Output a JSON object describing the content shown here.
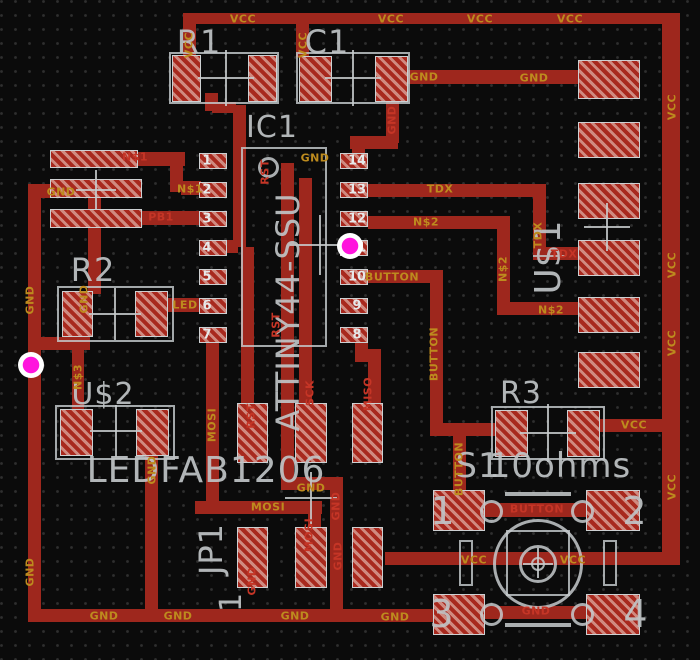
{
  "title": "PCB layout canvas - ATTINY44 board",
  "colors": {
    "background": "#0b0b0b",
    "grid_dot": "#2f2f2f",
    "copper_trace": "#9e271d",
    "pad_stripe_dark": "#a8291e",
    "pad_stripe_light": "#d08a80",
    "silkscreen": "#c0c4c6",
    "net_label_orange": "#bd8b1e",
    "net_label_red": "#c53526",
    "pin_number": "#e6e9ea",
    "click_marker": "#ff14dd"
  },
  "traces": [
    [
      183,
      13,
      479,
      11,
      "VCC"
    ],
    [
      662,
      13,
      18,
      552,
      "VCC"
    ],
    [
      183,
      24,
      13,
      34,
      "VCC"
    ],
    [
      296,
      24,
      13,
      33,
      "VCC"
    ],
    [
      407,
      70,
      172,
      14,
      "GND"
    ],
    [
      386,
      100,
      13,
      43,
      "GND"
    ],
    [
      350,
      136,
      48,
      13,
      "GND"
    ],
    [
      352,
      145,
      13,
      10,
      "GND"
    ],
    [
      205,
      93,
      13,
      18,
      "RST"
    ],
    [
      212,
      102,
      24,
      11,
      "RST"
    ],
    [
      233,
      105,
      13,
      142,
      "RST"
    ],
    [
      222,
      240,
      16,
      13,
      "RST"
    ],
    [
      241,
      247,
      13,
      158,
      "RST"
    ],
    [
      137,
      152,
      48,
      14,
      "N$1"
    ],
    [
      170,
      154,
      13,
      38,
      "N$1"
    ],
    [
      181,
      181,
      20,
      14,
      "N$1"
    ],
    [
      142,
      211,
      58,
      14,
      "PB1"
    ],
    [
      168,
      298,
      32,
      14,
      "LED"
    ],
    [
      28,
      184,
      26,
      14,
      "GND"
    ],
    [
      28,
      184,
      13,
      438,
      "GND"
    ],
    [
      88,
      196,
      13,
      98,
      "GND"
    ],
    [
      34,
      337,
      56,
      13,
      "GND"
    ],
    [
      72,
      335,
      12,
      77,
      "N$3"
    ],
    [
      145,
      453,
      13,
      160,
      "GND"
    ],
    [
      206,
      340,
      13,
      163,
      "MOSI"
    ],
    [
      195,
      501,
      127,
      13,
      "MOSI"
    ],
    [
      308,
      510,
      13,
      20,
      "MOSI"
    ],
    [
      281,
      163,
      13,
      316,
      "GND"
    ],
    [
      281,
      477,
      62,
      13,
      "GND"
    ],
    [
      330,
      477,
      13,
      136,
      "GND"
    ],
    [
      299,
      178,
      13,
      227,
      "SCK"
    ],
    [
      355,
      342,
      13,
      14,
      "MISO"
    ],
    [
      355,
      349,
      26,
      13,
      "MISO"
    ],
    [
      368,
      349,
      13,
      56,
      "MISO"
    ],
    [
      368,
      270,
      75,
      13,
      "BUTTON"
    ],
    [
      430,
      270,
      13,
      160,
      "BUTTON"
    ],
    [
      430,
      423,
      66,
      13,
      "BUTTON"
    ],
    [
      453,
      430,
      13,
      78,
      "BUTTON"
    ],
    [
      368,
      184,
      178,
      13,
      "TDX"
    ],
    [
      533,
      184,
      13,
      76,
      "TDX"
    ],
    [
      545,
      247,
      34,
      13,
      "TDX"
    ],
    [
      368,
      216,
      142,
      13,
      "N$2"
    ],
    [
      497,
      216,
      13,
      99,
      "N$2"
    ],
    [
      497,
      302,
      82,
      13,
      "N$2"
    ],
    [
      600,
      419,
      64,
      13,
      "VCC"
    ],
    [
      385,
      552,
      295,
      13,
      "VCC"
    ],
    [
      28,
      609,
      444,
      13,
      "GND"
    ],
    [
      485,
      503,
      102,
      14,
      "BUTTON"
    ],
    [
      485,
      606,
      102,
      13,
      "GND"
    ]
  ],
  "pads": [
    [
      172,
      55,
      29,
      47,
      "R1"
    ],
    [
      248,
      55,
      29,
      47,
      "R1"
    ],
    [
      299,
      56,
      33,
      46,
      "C1"
    ],
    [
      375,
      56,
      33,
      46,
      "C1"
    ],
    [
      50,
      150,
      88,
      18,
      "conn"
    ],
    [
      50,
      179,
      92,
      19,
      "conn"
    ],
    [
      50,
      209,
      92,
      19,
      "conn"
    ],
    [
      199,
      153,
      28,
      16,
      "IC1"
    ],
    [
      199,
      182,
      28,
      16,
      "IC1"
    ],
    [
      199,
      211,
      28,
      16,
      "IC1"
    ],
    [
      199,
      240,
      28,
      16,
      "IC1"
    ],
    [
      199,
      269,
      28,
      16,
      "IC1"
    ],
    [
      199,
      298,
      28,
      16,
      "IC1"
    ],
    [
      199,
      327,
      28,
      16,
      "IC1"
    ],
    [
      340,
      153,
      28,
      16,
      "IC1"
    ],
    [
      340,
      182,
      28,
      16,
      "IC1"
    ],
    [
      340,
      211,
      28,
      16,
      "IC1"
    ],
    [
      340,
      240,
      28,
      16,
      "IC1"
    ],
    [
      340,
      269,
      28,
      16,
      "IC1"
    ],
    [
      340,
      298,
      28,
      16,
      "IC1"
    ],
    [
      340,
      327,
      28,
      16,
      "IC1"
    ],
    [
      62,
      291,
      31,
      46,
      "R2"
    ],
    [
      135,
      291,
      33,
      46,
      "R2"
    ],
    [
      60,
      409,
      33,
      47,
      "U$2"
    ],
    [
      136,
      409,
      33,
      47,
      "U$2"
    ],
    [
      237,
      403,
      31,
      60,
      "JP1"
    ],
    [
      295,
      403,
      32,
      60,
      "JP1"
    ],
    [
      352,
      403,
      31,
      60,
      "JP1"
    ],
    [
      237,
      527,
      31,
      61,
      "JP1"
    ],
    [
      295,
      527,
      32,
      61,
      "JP1"
    ],
    [
      352,
      527,
      31,
      61,
      "JP1"
    ],
    [
      495,
      410,
      33,
      47,
      "R3"
    ],
    [
      567,
      410,
      33,
      47,
      "R3"
    ],
    [
      433,
      490,
      52,
      41,
      "S1"
    ],
    [
      586,
      490,
      54,
      41,
      "S1"
    ],
    [
      433,
      594,
      52,
      41,
      "S1"
    ],
    [
      586,
      594,
      54,
      41,
      "S1"
    ],
    [
      578,
      60,
      62,
      39,
      "U$1"
    ],
    [
      578,
      122,
      62,
      36,
      "U$1"
    ],
    [
      578,
      183,
      62,
      36,
      "U$1"
    ],
    [
      578,
      240,
      62,
      36,
      "U$1"
    ],
    [
      578,
      297,
      62,
      36,
      "U$1"
    ],
    [
      578,
      352,
      62,
      36,
      "U$1"
    ]
  ],
  "outlines": [
    [
      169,
      52,
      110,
      52,
      2,
      "R1-body"
    ],
    [
      296,
      52,
      114,
      52,
      2,
      "C1-body"
    ],
    [
      241,
      147,
      86,
      200,
      2,
      "IC1-body"
    ],
    [
      57,
      286,
      117,
      56,
      2,
      "R2-body"
    ],
    [
      55,
      405,
      120,
      55,
      2,
      "U$2-body"
    ],
    [
      491,
      406,
      114,
      54,
      2,
      "R3-body"
    ],
    [
      506,
      530,
      64,
      66,
      2,
      "S1-plunger-square"
    ],
    [
      459,
      540,
      14,
      46,
      2,
      "S1-left-stem"
    ],
    [
      603,
      540,
      14,
      46,
      2,
      "S1-right-stem"
    ]
  ],
  "circles": [
    [
      258,
      157,
      21,
      3,
      "IC1-pin1-dot"
    ],
    [
      493,
      519,
      90,
      3,
      "S1-button-outer"
    ],
    [
      519,
      545,
      38,
      3,
      "S1-button-mid"
    ],
    [
      531,
      557,
      14,
      2,
      "S1-button-center"
    ],
    [
      480,
      500,
      23,
      3,
      "S1-ring-1"
    ],
    [
      571,
      500,
      23,
      3,
      "S1-ring-2"
    ],
    [
      480,
      603,
      23,
      3,
      "S1-ring-3"
    ],
    [
      571,
      603,
      23,
      3,
      "S1-ring-4"
    ]
  ],
  "lines": [
    [
      198,
      77,
      56,
      2
    ],
    [
      225,
      50,
      2,
      56
    ],
    [
      325,
      77,
      56,
      2
    ],
    [
      352,
      50,
      2,
      56
    ],
    [
      76,
      189,
      40,
      2
    ],
    [
      95,
      170,
      2,
      40
    ],
    [
      290,
      244,
      60,
      2
    ],
    [
      319,
      215,
      2,
      60
    ],
    [
      89,
      313,
      52,
      2
    ],
    [
      114,
      288,
      2,
      52
    ],
    [
      90,
      430,
      52,
      2
    ],
    [
      115,
      405,
      2,
      52
    ],
    [
      285,
      497,
      52,
      2
    ],
    [
      310,
      472,
      2,
      52
    ],
    [
      520,
      432,
      56,
      2
    ],
    [
      547,
      404,
      2,
      58
    ],
    [
      584,
      226,
      46,
      2
    ],
    [
      606,
      203,
      2,
      48
    ],
    [
      523,
      563,
      30,
      2
    ],
    [
      537,
      548,
      2,
      30
    ],
    [
      505,
      492,
      66,
      4
    ],
    [
      505,
      623,
      66,
      4
    ]
  ],
  "silk_texts": [
    [
      "R1",
      199,
      42,
      32,
      0
    ],
    [
      "C1",
      327,
      42,
      32,
      0
    ],
    [
      "IC1",
      272,
      128,
      30,
      0
    ],
    [
      "ATTINY44-SSU",
      288,
      312,
      32,
      1
    ],
    [
      "R2",
      93,
      270,
      32,
      0
    ],
    [
      "U$2",
      103,
      395,
      30,
      0
    ],
    [
      "LEDFAB1206",
      206,
      471,
      36,
      0
    ],
    [
      "JP1",
      211,
      549,
      32,
      1
    ],
    [
      "1",
      232,
      602,
      30,
      1
    ],
    [
      "R3",
      521,
      394,
      30,
      0
    ],
    [
      "S1",
      478,
      466,
      34,
      0
    ],
    [
      "10ohms",
      560,
      466,
      34,
      0
    ],
    [
      "U$1",
      549,
      257,
      36,
      1
    ],
    [
      "1",
      443,
      511,
      38,
      0
    ],
    [
      "2",
      635,
      511,
      38,
      0
    ],
    [
      "3",
      442,
      614,
      38,
      0
    ],
    [
      "4",
      636,
      614,
      38,
      0
    ]
  ],
  "pin_numbers": [
    [
      "1",
      207,
      161
    ],
    [
      "2",
      207,
      190
    ],
    [
      "3",
      207,
      219
    ],
    [
      "4",
      207,
      248
    ],
    [
      "5",
      207,
      277
    ],
    [
      "6",
      207,
      306
    ],
    [
      "7",
      207,
      335
    ],
    [
      "14",
      357,
      161
    ],
    [
      "13",
      357,
      190
    ],
    [
      "12",
      357,
      219
    ],
    [
      "11",
      357,
      248
    ],
    [
      "10",
      357,
      277
    ],
    [
      "9",
      357,
      306
    ],
    [
      "8",
      357,
      335
    ]
  ],
  "net_labels": [
    [
      "VCC",
      243,
      19,
      "orange",
      0
    ],
    [
      "VCC",
      391,
      19,
      "orange",
      0
    ],
    [
      "VCC",
      480,
      19,
      "orange",
      0
    ],
    [
      "VCC",
      570,
      19,
      "orange",
      0
    ],
    [
      "VCC",
      672,
      107,
      "orange",
      1
    ],
    [
      "VCC",
      672,
      265,
      "orange",
      1
    ],
    [
      "VCC",
      672,
      343,
      "orange",
      1
    ],
    [
      "VCC",
      672,
      487,
      "orange",
      1
    ],
    [
      "VCC",
      189,
      45,
      "orange",
      1
    ],
    [
      "VCC",
      303,
      45,
      "orange",
      1
    ],
    [
      "GND",
      424,
      77,
      "orange",
      0
    ],
    [
      "GND",
      534,
      78,
      "orange",
      0
    ],
    [
      "GND",
      392,
      120,
      "red",
      1
    ],
    [
      "GND",
      315,
      158,
      "orange",
      0
    ],
    [
      "RST",
      265,
      172,
      "red",
      1
    ],
    [
      "RST",
      276,
      325,
      "red",
      1
    ],
    [
      "RST",
      251,
      416,
      "red",
      1
    ],
    [
      "N$1",
      135,
      157,
      "red",
      0
    ],
    [
      "GND",
      61,
      192,
      "orange",
      0
    ],
    [
      "PB1",
      161,
      217,
      "red",
      0
    ],
    [
      "N$1",
      190,
      189,
      "orange",
      0
    ],
    [
      "GND",
      30,
      300,
      "orange",
      1
    ],
    [
      "GND",
      30,
      572,
      "orange",
      1
    ],
    [
      "GND",
      84,
      299,
      "orange",
      1
    ],
    [
      "N$3",
      78,
      377,
      "orange",
      1
    ],
    [
      "LED",
      185,
      305,
      "orange",
      0
    ],
    [
      "GND",
      152,
      470,
      "orange",
      1
    ],
    [
      "MOSI",
      212,
      425,
      "orange",
      1
    ],
    [
      "MOSI",
      268,
      507,
      "orange",
      0
    ],
    [
      "MOSI",
      309,
      535,
      "red",
      1
    ],
    [
      "GND",
      311,
      488,
      "orange",
      0
    ],
    [
      "GND",
      336,
      506,
      "red",
      1
    ],
    [
      "GND",
      252,
      581,
      "red",
      1
    ],
    [
      "GND",
      338,
      556,
      "red",
      1
    ],
    [
      "SCK",
      310,
      393,
      "red",
      1
    ],
    [
      "MISO",
      368,
      394,
      "red",
      1
    ],
    [
      "GND",
      104,
      616,
      "orange",
      0
    ],
    [
      "GND",
      178,
      616,
      "orange",
      0
    ],
    [
      "GND",
      295,
      616,
      "orange",
      0
    ],
    [
      "GND",
      395,
      617,
      "orange",
      0
    ],
    [
      "GND",
      536,
      611,
      "red",
      0
    ],
    [
      "BUTTON",
      392,
      277,
      "orange",
      0
    ],
    [
      "BUTTON",
      434,
      354,
      "orange",
      1
    ],
    [
      "BUTTON",
      459,
      469,
      "orange",
      1
    ],
    [
      "BUTTON",
      537,
      509,
      "red",
      0
    ],
    [
      "VCC",
      474,
      560,
      "orange",
      0
    ],
    [
      "VCC",
      573,
      560,
      "orange",
      0
    ],
    [
      "VCC",
      634,
      425,
      "orange",
      0
    ],
    [
      "TDX",
      440,
      189,
      "orange",
      0
    ],
    [
      "TDX",
      538,
      235,
      "orange",
      1
    ],
    [
      "TDX",
      564,
      254,
      "red",
      0
    ],
    [
      "N$2",
      426,
      222,
      "orange",
      0
    ],
    [
      "N$2",
      503,
      269,
      "orange",
      1
    ],
    [
      "N$2",
      551,
      310,
      "orange",
      0
    ]
  ],
  "markers": [
    [
      350,
      246
    ],
    [
      31,
      365
    ]
  ]
}
